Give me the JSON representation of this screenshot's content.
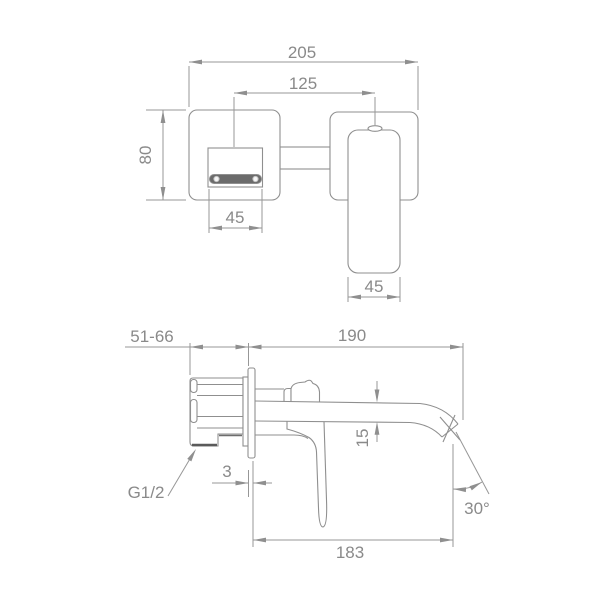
{
  "drawing": {
    "kind": "technical-dimension-drawing",
    "subject": "wall-mounted-basin-mixer-faucet",
    "colors": {
      "background": "#ffffff",
      "line": "#8f8f8f",
      "text": "#8a8a8a",
      "dark_fill": "#6b6b6b"
    }
  },
  "front_view": {
    "overall_width": "205",
    "hole_spacing": "125",
    "plate_height": "80",
    "spout_width": "45",
    "handle_width": "45"
  },
  "side_view": {
    "installation_depth": "51-66",
    "spout_reach": "190",
    "spout_tube_height": "15",
    "trim_plate_thickness": "3",
    "outlet_projection": "183",
    "outlet_angle": "30°",
    "inlet_thread": "G1/2"
  }
}
